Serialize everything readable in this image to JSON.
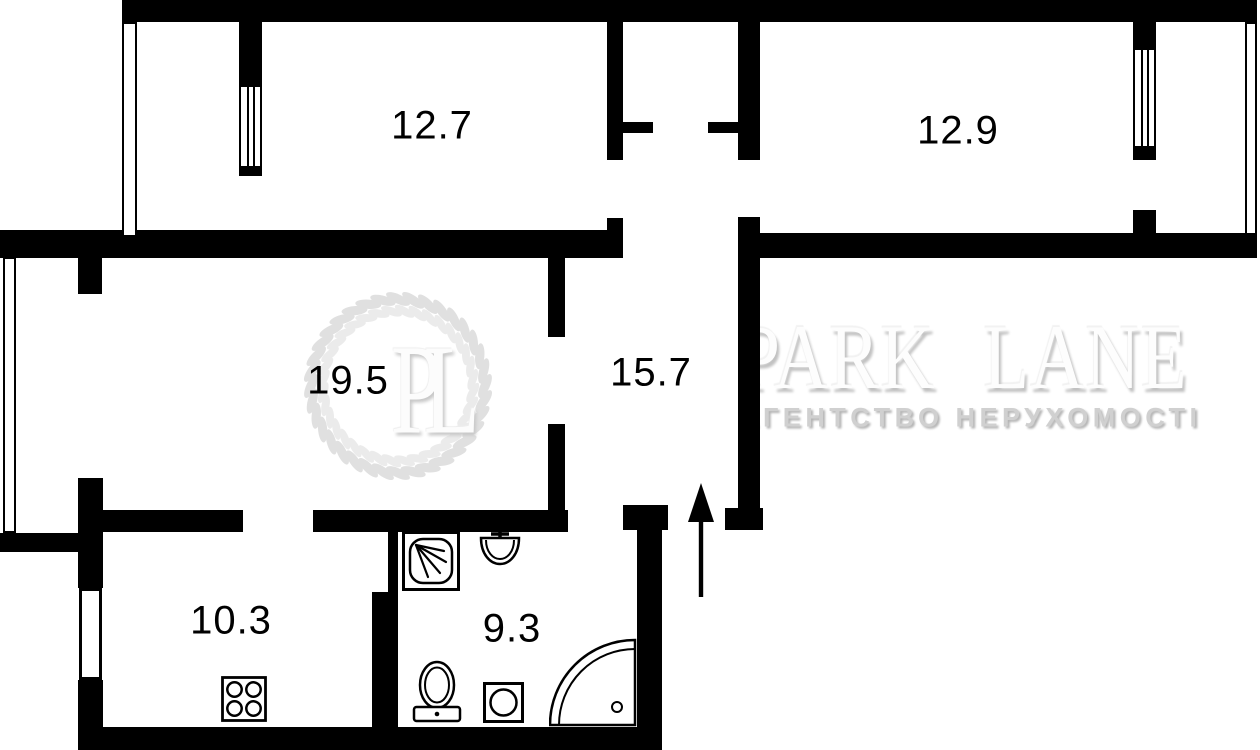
{
  "plan": {
    "rooms": [
      {
        "id": "room-top-left",
        "area": "12.7"
      },
      {
        "id": "room-top-right",
        "area": "12.9"
      },
      {
        "id": "living-room",
        "area": "19.5"
      },
      {
        "id": "hallway",
        "area": "15.7"
      },
      {
        "id": "kitchen",
        "area": "10.3"
      },
      {
        "id": "bathroom",
        "area": "9.3"
      }
    ],
    "fixtures": [
      "shower-tray",
      "wash-basin",
      "toilet",
      "washing-machine",
      "corner-bathtub",
      "stove-4-burner"
    ],
    "entrance": {
      "direction": "up"
    }
  },
  "watermark": {
    "monogram": "PL",
    "brand": "PARK LANE",
    "tagline": "АГЕНТСТВО НЕРУХОМОСТІ"
  },
  "colors": {
    "wall": "#000000",
    "background": "#ffffff",
    "watermark_leaf": "#e0e0e0",
    "watermark_text": "#d0d0d0"
  }
}
